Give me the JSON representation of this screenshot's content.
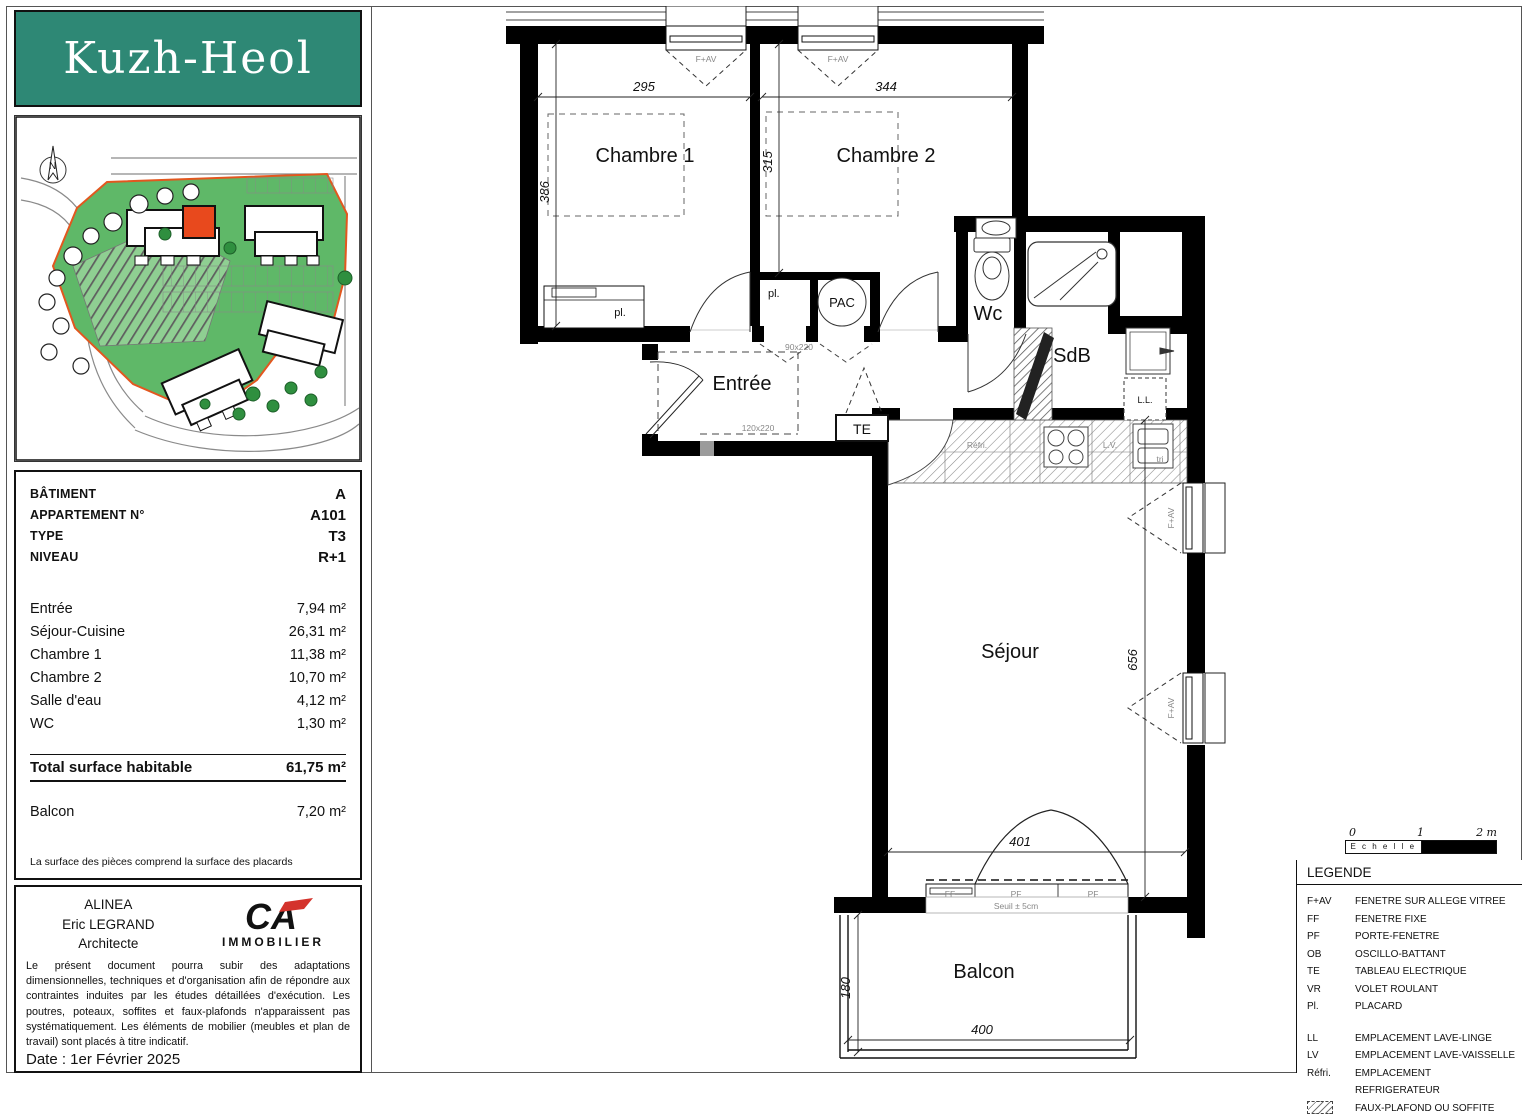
{
  "logo": {
    "title": "Kuzh-Heol",
    "bg_color": "#2E8875"
  },
  "site_plan": {
    "north_label": "N",
    "site_color": "#5FB868",
    "boundary_color": "#E2571F",
    "highlight_color": "#E8491D"
  },
  "info_panel": {
    "header_rows": [
      {
        "label": "BÂTIMENT",
        "value": "A"
      },
      {
        "label": "APPARTEMENT N°",
        "value": "A101"
      },
      {
        "label": "TYPE",
        "value": "T3"
      },
      {
        "label": "NIVEAU",
        "value": "R+1"
      }
    ],
    "area_rows": [
      {
        "label": "Entrée",
        "value": "7,94 m²"
      },
      {
        "label": "Séjour-Cuisine",
        "value": "26,31 m²"
      },
      {
        "label": "Chambre 1",
        "value": "11,38 m²"
      },
      {
        "label": "Chambre 2",
        "value": "10,70 m²"
      },
      {
        "label": "Salle d'eau",
        "value": "4,12 m²"
      },
      {
        "label": "WC",
        "value": "1,30 m²"
      }
    ],
    "total_row": {
      "label": "Total surface habitable",
      "value": "61,75 m²"
    },
    "balcony_row": {
      "label": "Balcon",
      "value": "7,20 m²"
    },
    "footnote": "La surface des pièces comprend la surface des placards"
  },
  "architect_panel": {
    "firm": "ALINEA",
    "architect": "Eric LEGRAND",
    "role": "Architecte",
    "brand_initials": "CA",
    "brand_label": "IMMOBILIER",
    "disclaimer": "Le présent document pourra subir des adaptations dimensionnelles, techniques et d'organisation afin de répondre aux contraintes induites par les études détaillées d'exécution. Les poutres, poteaux, soffites et faux-plafonds n'apparaissent pas systématiquement. Les éléments de mobilier (meubles et plan de travail) sont placés à titre indicatif.",
    "date_line": "Date : 1er Février 2025"
  },
  "plan": {
    "rooms": {
      "chambre1": "Chambre 1",
      "chambre2": "Chambre 2",
      "entree": "Entrée",
      "wc": "Wc",
      "sdb": "SdB",
      "sejour": "Séjour",
      "balcon": "Balcon"
    },
    "dims": {
      "chambre1_w": "295",
      "chambre1_h": "386",
      "chambre2_w": "344",
      "chambre2_h": "315",
      "sejour_h": "656",
      "sejour_w": "401",
      "balcon_w": "400",
      "balcon_h": "180"
    },
    "marks": {
      "fav": "F+AV",
      "ff": "FF",
      "pf": "PF",
      "te": "TE",
      "pac": "PAC",
      "pl": "pl.",
      "ll": "L.L.",
      "lv": "L.V.",
      "refri": "Réfri.",
      "tri": "tri",
      "seuil": "Seuil ± 5cm",
      "door_passage": "120x220",
      "door_small": "90x220"
    }
  },
  "scale_bar": {
    "label": "E c h e l l e",
    "ticks": [
      "0",
      "1",
      "2 m"
    ]
  },
  "legend": {
    "title": "LEGENDE",
    "openings": [
      {
        "abbr": "F+AV",
        "desc": "FENETRE SUR ALLEGE VITREE"
      },
      {
        "abbr": "FF",
        "desc": "FENETRE FIXE"
      },
      {
        "abbr": "PF",
        "desc": "PORTE-FENETRE"
      },
      {
        "abbr": "OB",
        "desc": "OSCILLO-BATTANT"
      },
      {
        "abbr": "TE",
        "desc": "TABLEAU ELECTRIQUE"
      },
      {
        "abbr": "VR",
        "desc": "VOLET ROULANT"
      },
      {
        "abbr": "Pl.",
        "desc": "PLACARD"
      }
    ],
    "equipment": [
      {
        "abbr": "LL",
        "desc": "EMPLACEMENT LAVE-LINGE"
      },
      {
        "abbr": "LV",
        "desc": "EMPLACEMENT LAVE-VAISSELLE"
      },
      {
        "abbr": "Réfri.",
        "desc": "EMPLACEMENT REFRIGERATEUR"
      }
    ],
    "hatch_desc": "FAUX-PLAFOND OU SOFFITE"
  }
}
